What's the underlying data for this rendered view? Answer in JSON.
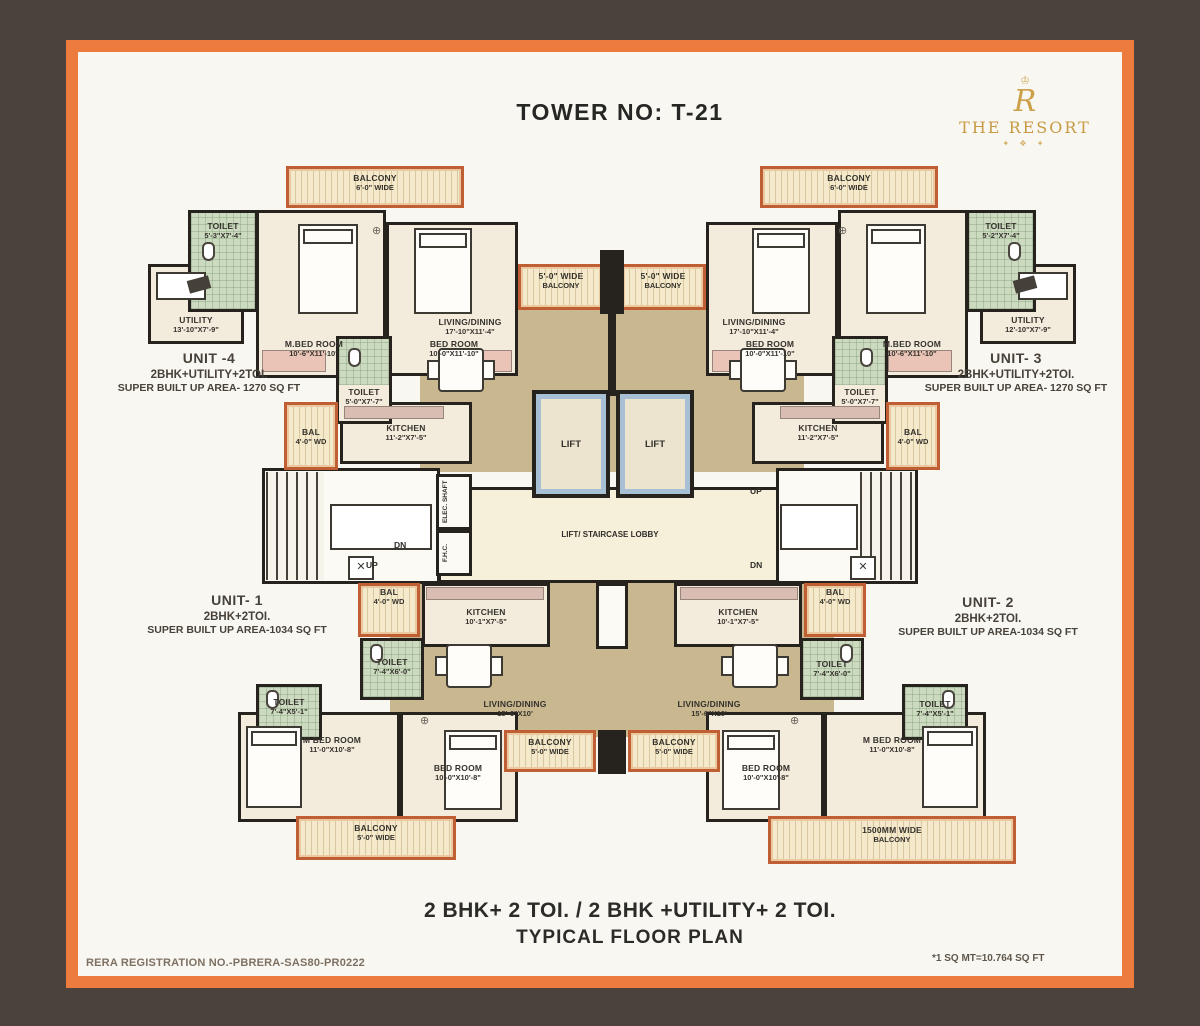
{
  "palette": {
    "background": "#4a423b",
    "frame_orange": "#ec7b3d",
    "paper": "#f9f7f1",
    "wall_black": "#26231f",
    "floor_tan": "#c9b88f",
    "room_cream": "#f3ecdd",
    "toilet_green": "#ccdabf",
    "balcony_trim": "#bf5f33",
    "lift_blue": "#a8c0d6",
    "logo_gold": "#c9a052"
  },
  "header": {
    "title": "TOWER NO: T-21"
  },
  "logo": {
    "monogram": "R",
    "brand": "THE RESORT"
  },
  "units": {
    "unit4": {
      "name": "UNIT -4",
      "type": "2BHK+UTILITY+2TOI.",
      "area": "SUPER BUILT UP AREA- 1270  SQ FT"
    },
    "unit3": {
      "name": "UNIT- 3",
      "type": "2BHK+UTILITY+2TOI.",
      "area": "SUPER BUILT UP AREA- 1270  SQ FT"
    },
    "unit1": {
      "name": "UNIT- 1",
      "type": "2BHK+2TOI.",
      "area": "SUPER BUILT UP AREA-1034 SQ FT"
    },
    "unit2": {
      "name": "UNIT- 2",
      "type": "2BHK+2TOI.",
      "area": "SUPER BUILT UP AREA-1034 SQ FT"
    }
  },
  "rooms": {
    "balcony6": {
      "name": "BALCONY",
      "dim": "6'-0\" WIDE"
    },
    "balcony5wide": {
      "name": "5'-0\" WIDE",
      "dim": "BALCONY"
    },
    "balcony5": {
      "name": "BALCONY",
      "dim": "5'-0\" WIDE"
    },
    "balcony1500": {
      "name": "1500MM WIDE",
      "dim": "BALCONY"
    },
    "toilet_a": {
      "name": "TOILET",
      "dim": "5'-3\"X7'-4\""
    },
    "toilet_b": {
      "name": "TOILET",
      "dim": "5'-2\"X7'-4\""
    },
    "toilet_c": {
      "name": "TOILET",
      "dim": "5'-0\"X7'-7\""
    },
    "toilet_d": {
      "name": "TOILET",
      "dim": "7'-4\"X6'-0\""
    },
    "toilet_e": {
      "name": "TOILET",
      "dim": "7'-4\"X5'-1\""
    },
    "mbed_top": {
      "name": "M.BED ROOM",
      "dim": "10'-6\"X11'-10\""
    },
    "bed_top": {
      "name": "BED ROOM",
      "dim": "10'-0\"X11'-10\""
    },
    "utility_left": {
      "name": "UTILITY",
      "dim": "13'-10\"X7'-9\""
    },
    "utility_right": {
      "name": "UTILITY",
      "dim": "12'-10\"X7'-9\""
    },
    "living_top": {
      "name": "LIVING/DINING",
      "dim": "17'-10\"X11'-4\""
    },
    "kitchen_top": {
      "name": "KITCHEN",
      "dim": "11'-2\"X7'-5\""
    },
    "bal4": {
      "name": "BAL",
      "dim": "4'-0\" WD"
    },
    "kitchen_bot": {
      "name": "KITCHEN",
      "dim": "10'-1\"X7'-5\""
    },
    "living_bot": {
      "name": "LIVING/DINING",
      "dim": "15'-6\"X10'"
    },
    "mbed_bot": {
      "name": "M BED ROOM",
      "dim": "11'-0\"X10'-8\""
    },
    "bed_bot": {
      "name": "BED ROOM",
      "dim": "10'-0\"X10'-8\""
    }
  },
  "core": {
    "lift": "LIFT",
    "lobby": "LIFT/ STAIRCASE LOBBY",
    "up": "UP",
    "dn": "DN",
    "elec_shaft": "ELEC. SHAFT",
    "fhc": "F.H.C."
  },
  "footer": {
    "line1": "2 BHK+ 2 TOI. / 2 BHK +UTILITY+ 2 TOI.",
    "line2": "TYPICAL FLOOR PLAN",
    "rera": "RERA REGISTRATION NO.-PBRERA-SAS80-PR0222",
    "note": "*1 SQ MT=10.764 SQ FT"
  }
}
